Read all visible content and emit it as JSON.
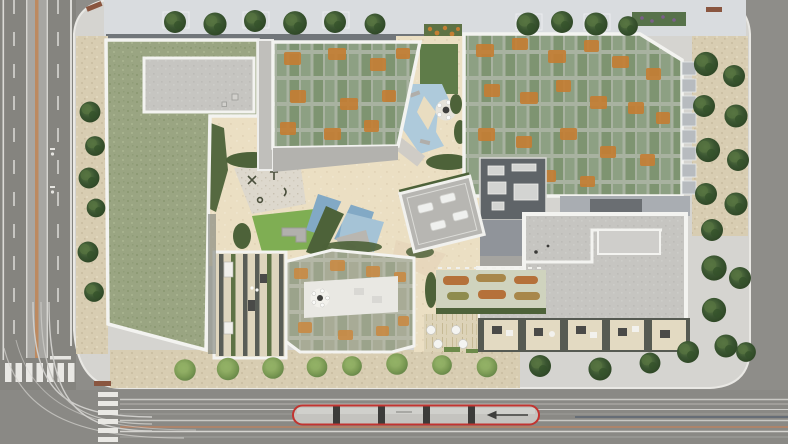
{
  "meta": {
    "kind": "architectural-aerial-rendering",
    "view": "top-down site plan of an urban residential block",
    "title": ""
  },
  "colors": {
    "asphalt": "#8e8d89",
    "asphalt_dark": "#82817c",
    "road_median": "#a7a6a2",
    "median_stripe": "#bd8a60",
    "lane_line": "#dcdbd7",
    "crosswalk": "#e9e8e4",
    "platform": "#d5d4d0",
    "north_deck": "#d9dcdf",
    "wall_shadow": "#71767a",
    "gravel": "#d8cdb2",
    "sand": "#ebdfc3",
    "path_warm": "#e3cfb5",
    "grass_roof": "#9aa582",
    "sedum_dark": "#7e9471",
    "bloom_orange": "#c47e34",
    "concrete": "#c6c5c1",
    "parapet": "#f3f3f0",
    "dark_roof": "#5f6468",
    "mid_roof": "#b3b2ae",
    "pool_light": "#aecadb",
    "pool_deep": "#82a9c5",
    "lawn_bright": "#7fae53",
    "lawn_dark": "#5f7c49",
    "hedge": "#4d6239",
    "playground": "#ddd8cd",
    "terrace_deck": "#ded5bd",
    "deck_stripe": "#595d57",
    "white_terrace": "#e9e8e3",
    "garden_orange": "#b5713a",
    "garden_olive": "#8f8c4e",
    "bed_ground": "#cfd3be",
    "tram_red": "#c23430",
    "tram_body": "#c4c3bf",
    "tram_joint": "#3c3c3a",
    "track_line": "#cac9c5",
    "track_rust": "#c2815c",
    "bench": "#8a5640",
    "skylight": "#eff0ee",
    "balcony": "#b7bbbf"
  },
  "scene": {
    "roads": {
      "left_street": {
        "orientation": "vertical",
        "median_stripe": "rust",
        "crosswalk": true,
        "lane_markings": "dashed"
      },
      "bottom_street": {
        "orientation": "horizontal",
        "tram_tracks": true,
        "crosswalk": true,
        "curved_track_junction": "bottom-left"
      },
      "tram": {
        "segments": 5,
        "outline_color": "red",
        "direction_arrow": "left"
      }
    },
    "buildings": [
      {
        "id": "west-block",
        "roof": "grass roof with concrete plant section"
      },
      {
        "id": "north-block",
        "roof": "sedum checker roof with orange blooms"
      },
      {
        "id": "east-block",
        "roof": "large sedum checker roof with orange blooms and street balconies"
      },
      {
        "id": "center-tower",
        "roof": "dark roof with HVAC units"
      },
      {
        "id": "southeast-block",
        "roof": "light concrete roof with stepped parapet"
      },
      {
        "id": "south-block",
        "roof": "pale sedum roof with white roof terrace and round table"
      },
      {
        "id": "southwest-terrace-block",
        "roof": "striped deck terrace with planters"
      },
      {
        "id": "courtyard-pavilion",
        "roof": "rotated gray roof with 4 skylights"
      }
    ],
    "courtyard": {
      "pools": 2,
      "playground": true,
      "bright_lawn": true,
      "dark_lawn": true,
      "round_table_chairs": 5,
      "garden_beds": 6,
      "loungers": 3
    },
    "vegetation": {
      "street_trees_top": 10,
      "street_trees_right_column": 9,
      "corner_tree_cluster": 6,
      "west_strip_trees": 6,
      "sidewalk_shrubs_south": 8,
      "sidewalk_trees_south": 3,
      "planter_boxes": 2
    },
    "furniture": {
      "benches": 3,
      "umbrellas": 4,
      "terrace_patios": 5
    }
  }
}
